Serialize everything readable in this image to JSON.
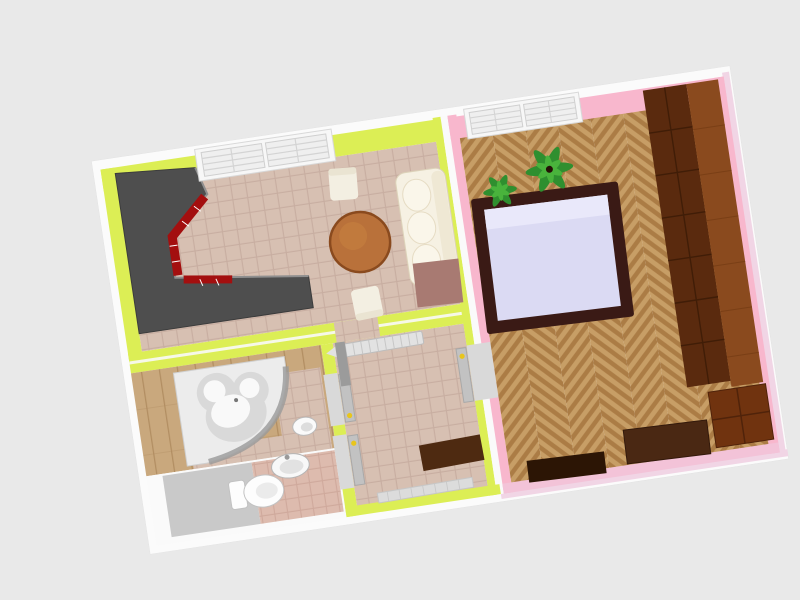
{
  "scene": {
    "view": "3d-floorplan-aerial",
    "background": "#e9e9e9",
    "rotation_deg": -8.5,
    "outer_wall": "#fbfbfb",
    "outer_trim_pink": "#f1d5e5"
  },
  "rooms": {
    "living_kitchen": {
      "name": "living-room-kitchen",
      "wall": "#dcee55",
      "floor": "#d7c0b2",
      "grout": "#c8aea1"
    },
    "bedroom": {
      "name": "bedroom",
      "wall": "#f8b7cd",
      "wall_south": "#f3c3d8",
      "floor_light": "#c79e66",
      "floor_dark": "#ab7c45"
    },
    "bathroom": {
      "name": "bathroom",
      "wood": "#c9a87d",
      "wood_line": "#b28e62",
      "tile": "#d9c2b3",
      "tile_grout": "#c8ab9c"
    },
    "wc": {
      "name": "toilet-room",
      "wall": "#fafafa",
      "floor_gray": "#c9c9c9",
      "tile": "#ddbbae",
      "tile_grout": "#cfa99c"
    },
    "hallway": {
      "name": "hallway",
      "wall": "#dcee55",
      "floor": "#d7c0b2"
    }
  },
  "furniture": {
    "kitchen_counter": {
      "body": "#4e4e4e",
      "edge": "#8f8f8f",
      "front_red": "#a30f0f",
      "seam": "#ffffff"
    },
    "dining_table": {
      "top": "#b9713a",
      "rim": "#8a4a1e"
    },
    "chair": {
      "body": "#f3efe2",
      "line": "#d8d2bc",
      "back": "#eae4d2"
    },
    "sofa": {
      "body": "#f6f1e3",
      "back": "#efe8d4",
      "cushion": "#faf6ea",
      "line": "#ddd3ba"
    },
    "rug": {
      "color": "#a87a72",
      "line": "#987066"
    },
    "window": {
      "frame": "#f7f7f7",
      "pane": "#efefef",
      "grid": "#d4d4d4",
      "line": "#d8d8d8"
    },
    "bed": {
      "frame": "#3a1a15",
      "mattress": "#dbdaf3",
      "pillow": "#e9e8fa"
    },
    "wardrobe": {
      "front": "#5a2a0e",
      "side": "#8a4a1e",
      "seam": "#401d07",
      "side_seam": "#7a3f16"
    },
    "dresser": {
      "body": "#70330f",
      "seam": "#50230a"
    },
    "desk": {
      "body": "#4a2813"
    },
    "sideboard": {
      "body": "#2c1505"
    },
    "plant": {
      "leaf_dark": "#2f8f2f",
      "leaf_light": "#49b33c",
      "pot": "#4a2a10",
      "soil": "#241106"
    },
    "bathtub": {
      "platform": "#ececec",
      "platform_line": "#cfcfcf",
      "rim_shadow": "#9a9a9a",
      "basin": "#d9d9d9",
      "highlight": "#f9f9f9",
      "drain": "#777777"
    },
    "toilet": {
      "body": "#fdfdfd",
      "line": "#c2c2c2",
      "inner": "#ebebeb"
    },
    "sink": {
      "body": "#f8f8f8",
      "inner": "#e2e2e2",
      "line": "#b5b5b5",
      "faucet": "#999999"
    },
    "bidet": {
      "body": "#fafafa",
      "inner": "#dddddd",
      "line": "#bbbbbb"
    },
    "radiator": {
      "body": "#e2e2e2",
      "line": "#c6c6c6"
    },
    "bench": {
      "body": "#4e2a11"
    },
    "shoe_shelf": {
      "body": "#dcdcdc",
      "line": "#c6c6c6"
    },
    "door": {
      "leaf": "#c2c2c2",
      "leaf_dark": "#9b9b9b",
      "opening": "#d9d9d9",
      "line": "#a8a8a8",
      "handle": "#e8c51c"
    }
  }
}
